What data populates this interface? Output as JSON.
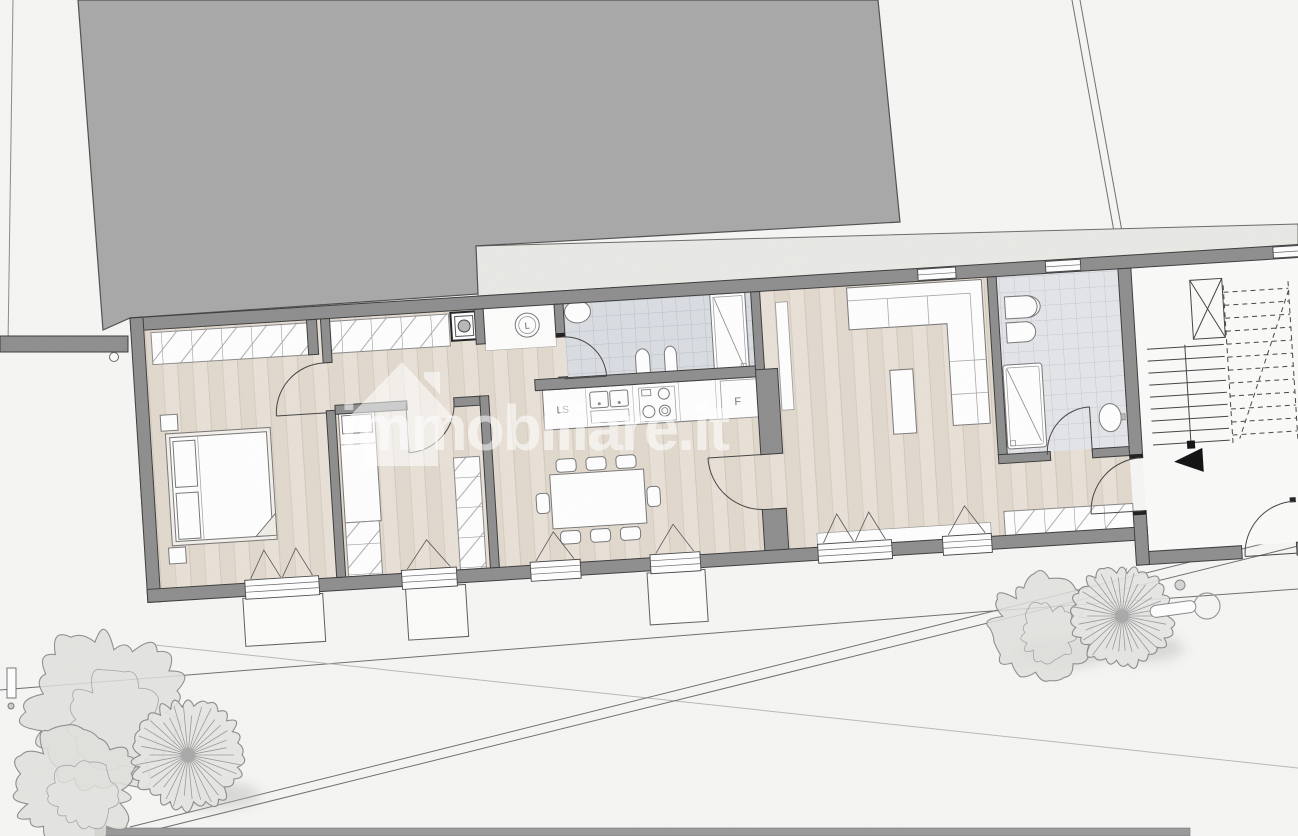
{
  "watermark": {
    "text": "immobiliare.it",
    "logo": "house-icon",
    "color": "#ffffff",
    "opacity": 0.55
  },
  "plan": {
    "labels": {
      "dishwasher": "LS",
      "fridge": "F",
      "washing_machine": "L"
    }
  },
  "palette": {
    "neighbor_building": "#a8a8a8",
    "walls": "#8e8e8e",
    "wall_outline": "#3c3c3c",
    "wood_floor": "#e8e0d6",
    "tile_floor_1": "#dadde2",
    "tile_floor_2": "#e3e5e9",
    "terrace": "#e9e9e6",
    "background": "#f7f7f5",
    "furniture": "#ffffff",
    "tree_stroke": "#8f8f8f"
  }
}
